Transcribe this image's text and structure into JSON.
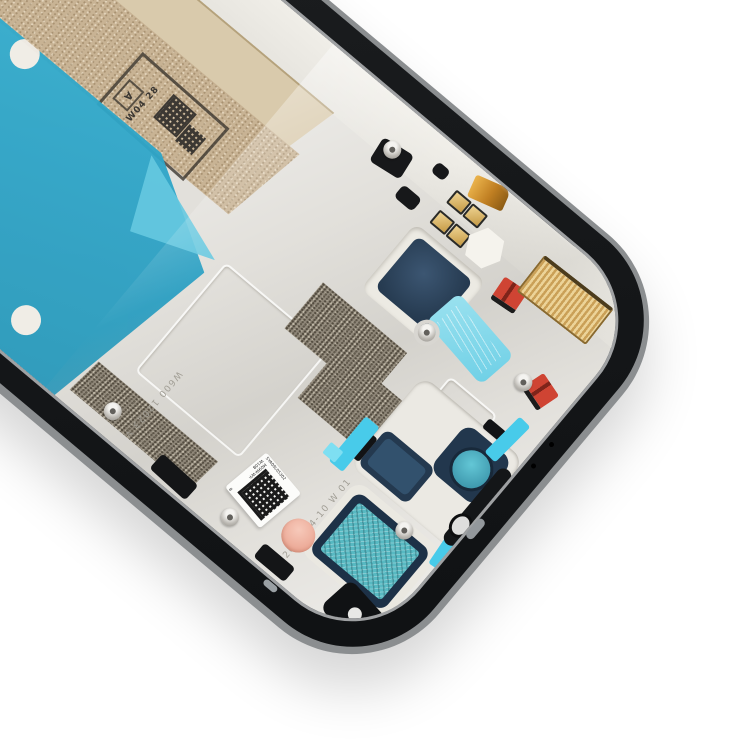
{
  "scene": {
    "description": "Smartphone LCD mid-frame spare part photographed tilted on a white background",
    "background_color": "#ffffff"
  },
  "frame": {
    "rail_color": "#1a1c1e",
    "outer_rim_color": "#8b8e90",
    "plate_color": "#e2e0db",
    "lip_color": "#efede7"
  },
  "adhesive": {
    "band_light_color": "#d9caac",
    "band_dark_color": "#c8b394",
    "teal_film_color": "#2ea5c8",
    "fold_highlight_color": "#66c9e0"
  },
  "stamp": {
    "letter": "A",
    "code": "W04 28",
    "ink_color": "#3c3833"
  },
  "etched": {
    "date_text": "2023-04-10 W 01",
    "code_text": "W600 12023 V",
    "color": "#a19e95"
  },
  "sticker": {
    "text_top": "5YA09L05302",
    "text_left": "M09W-WY-W10B",
    "text_bottom": "8",
    "background": "#fcfcfa"
  },
  "parts": {
    "navy_pad_color": "#273c52",
    "blue_tab_color": "#7fd6e8",
    "gold_contact_color": "#c59a45",
    "kapton_color": "#c07f22",
    "fingerstock_color": "#caa057",
    "red_clip_color": "#cf4433",
    "graphite_color": "#8f8779",
    "camera_cushion_color": "#22374d",
    "camera_lens_color": "#4fb6c6",
    "speaker_mesh_color": "#57b9c2",
    "mic_foam_color": "#eba895",
    "cyan_tape_color": "#48cbea"
  }
}
